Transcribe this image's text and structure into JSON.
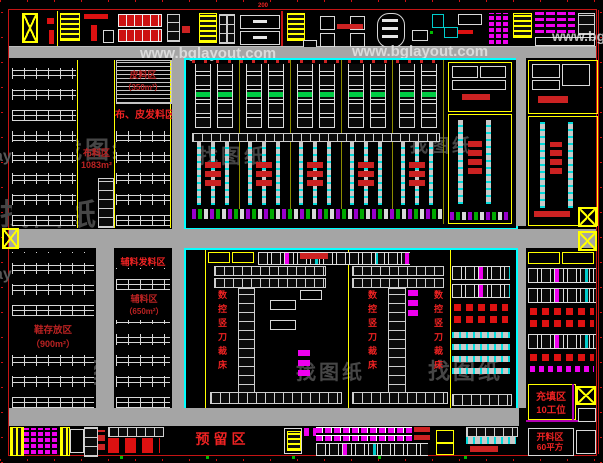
{
  "title": "鞋厂车间设备布置图 (CAD floor plan)",
  "colors": {
    "background": "#000000",
    "dimension_red": "#d01010",
    "zone_yellow": "#ffff00",
    "highlight_cyan": "#00ffff",
    "machine_magenta": "#ee00ee",
    "machine_green": "#00cc44",
    "corridor_gray": "#a5a5a5",
    "label_red": "#ee2222"
  },
  "watermarks": {
    "site": "www.bglayout.com",
    "site_partial": "ayout.com",
    "site_partial_right": "www.bg",
    "logo_text": "找图纸"
  },
  "dims": {
    "top_dim": "200"
  },
  "labels": {
    "leather_zone_1": "皮料区",
    "leather_zone_2": "（350m²）",
    "fabric_leather_issue": "布、皮发料区",
    "fabric_zone_1": "布料区",
    "fabric_zone_2": "1083m²",
    "shoe_storage_1": "鞋存放区",
    "shoe_storage_2": "（900m²）",
    "trim_issue_zone": "辅料发料区",
    "trim_zone_1": "辅料区",
    "trim_zone_2": "（650m²）",
    "cnc_cutter": "数控竖刀裁床",
    "reserved_zone": "预留区",
    "filling_zone_1": "充填区",
    "filling_zone_2": "10工位",
    "cutting_zone_1": "开料区",
    "cutting_zone_2": "60平方"
  }
}
